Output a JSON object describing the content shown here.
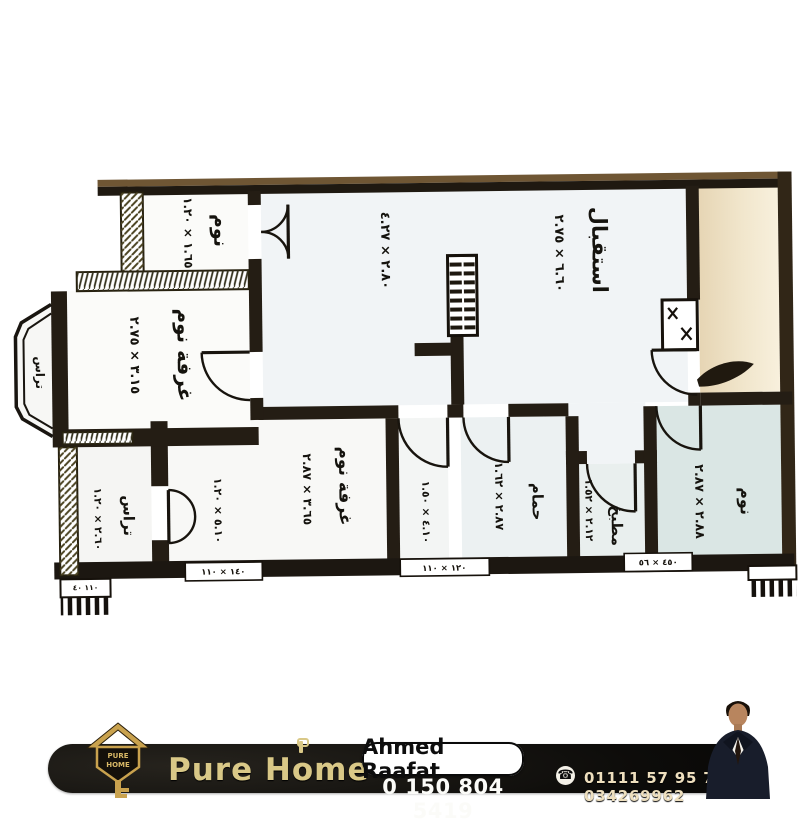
{
  "floor_plan": {
    "rooms": [
      {
        "name": "نوم",
        "dims": "١.٦٥ × ١.٢٠"
      },
      {
        "name": "غرفة نوم",
        "dims": "٣.١٥ × ٢.٧٥"
      },
      {
        "name": "استقبال",
        "dims": "٦.٦٠ × ٢.٧٥"
      },
      {
        "name": "",
        "dims": "٢.٨٠ × ٤.٢٧"
      },
      {
        "name": "تراس",
        "dims": ""
      },
      {
        "name": "تراس",
        "dims": "٢.٦٠ × ١.٢٠"
      },
      {
        "name": "غرفة نوم",
        "dims": "٣.٦٥ × ٢.٨٧"
      },
      {
        "name": "",
        "dims": "٥.١٠ × ١.٢٠"
      },
      {
        "name": "",
        "dims": "٤.١٠ × ١.٥٠"
      },
      {
        "name": "حمام",
        "dims": "٢.٨٧ × ١.٦٢"
      },
      {
        "name": "مطبخ",
        "dims": "٢.١٢ × ١.٥٢"
      },
      {
        "name": "نوم",
        "dims": "٢.٨٨ × ٢.٨٧"
      }
    ],
    "window_tags": [
      "١٤٠ × ١١٠",
      "١٢٠ × ١١٠",
      "٤٥٠ × ٥٦",
      "١١٠ ٤٠"
    ]
  },
  "footer": {
    "brand_part1": "Pure H",
    "brand_o": "o",
    "brand_part2": "me",
    "logo_line1": "PURE",
    "logo_line2": "HOME",
    "agent_name": "Ahmed  Raafat",
    "phone_main": "0 150 804 5419",
    "phone_icon": "☎",
    "phones_secondary": "01111 57 95 79 — 034269962"
  },
  "colors": {
    "accent_gold": "#d9c887",
    "wall_dark": "#221b12",
    "wall_brown": "#6f5634",
    "outside_tan": "#e9dabb",
    "room_blue": "#dae6e4"
  }
}
